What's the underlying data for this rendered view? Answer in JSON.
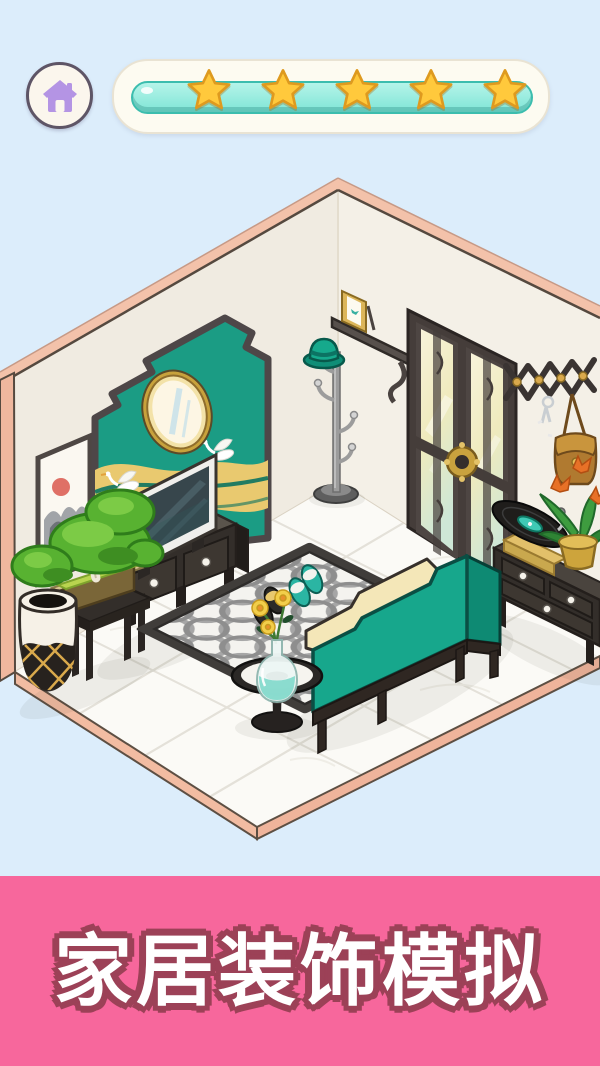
{
  "app": {
    "background_color": "#DCEDFB"
  },
  "header": {
    "home_button": {
      "icon": "home-icon",
      "icon_color": "#B494E4"
    },
    "progress": {
      "stars_total": 5,
      "stars_filled": 5,
      "percent": 100,
      "bar_color": "#8FEADF",
      "star_color": "#FFC93C",
      "star_outline": "#DE9A1F"
    }
  },
  "scene": {
    "colors": {
      "wall": "#F2EEE4",
      "wall_trim": "#F3C2AA",
      "floor": "#FBFAF6",
      "floor_edge": "#F2BCA2",
      "accent_teal": "#1B9C84",
      "sofa_teal": "#17A78C",
      "gold": "#E9C96F"
    },
    "items": [
      {
        "name": "hanging-scroll-art"
      },
      {
        "name": "accent-wall-panel"
      },
      {
        "name": "oval-mirror"
      },
      {
        "name": "crane-motif"
      },
      {
        "name": "tv"
      },
      {
        "name": "tv-stand"
      },
      {
        "name": "bonsai-tree"
      },
      {
        "name": "plant-stool"
      },
      {
        "name": "trash-bin"
      },
      {
        "name": "wall-shelf"
      },
      {
        "name": "photo-frame"
      },
      {
        "name": "coat-stand"
      },
      {
        "name": "hat"
      },
      {
        "name": "double-door"
      },
      {
        "name": "accordion-wall-rack"
      },
      {
        "name": "keys"
      },
      {
        "name": "handbag"
      },
      {
        "name": "record-player"
      },
      {
        "name": "drawer-cabinet"
      },
      {
        "name": "potted-plant"
      },
      {
        "name": "area-rug"
      },
      {
        "name": "slippers-teal"
      },
      {
        "name": "slippers-black"
      },
      {
        "name": "sofa"
      },
      {
        "name": "side-table"
      },
      {
        "name": "flower-vase"
      }
    ]
  },
  "banner": {
    "title": "家居装饰模拟",
    "bg_color": "#F7679C",
    "text_color": "#FFFFFF",
    "outline_color": "#9C4157"
  }
}
